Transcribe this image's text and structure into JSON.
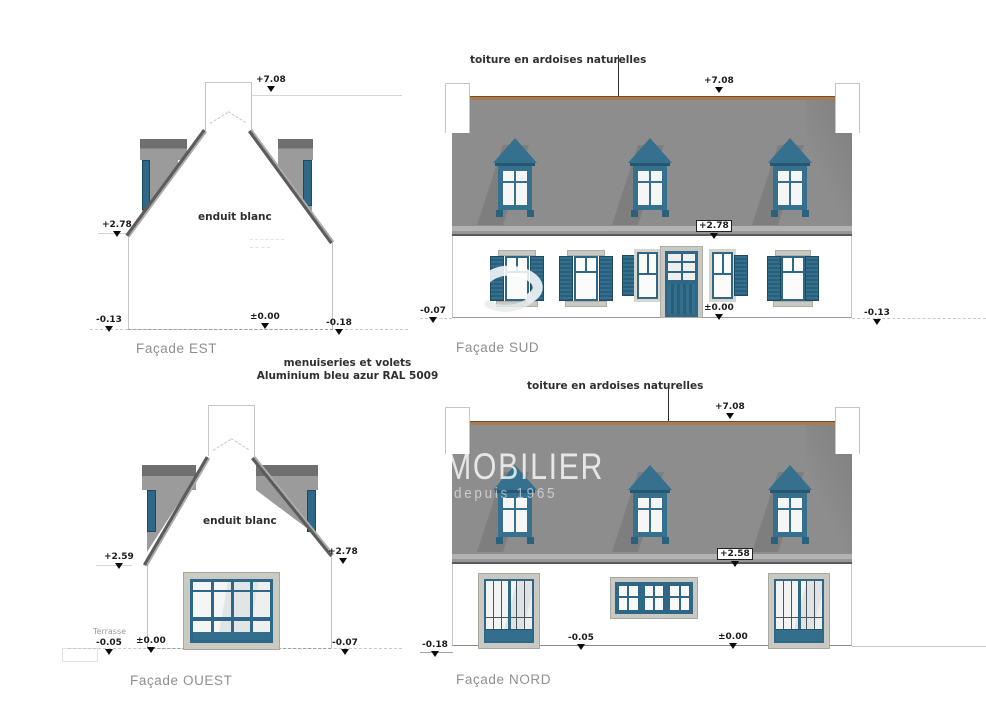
{
  "annotations": {
    "roof_note": "toiture en ardoises naturelles",
    "wall_note": "enduit blanc",
    "terrace_label": "Terrasse",
    "joinery_note_line1": "menuiseries et volets",
    "joinery_note_line2": "Aluminium bleu azur RAL 5009"
  },
  "watermark": {
    "line1": "MOBILIER",
    "line2": "depuis 1965"
  },
  "facades": {
    "est": {
      "title": "Façade EST",
      "levels": {
        "ridge": "+7.08",
        "eave_left": "+2.78",
        "ground_left": "-0.13",
        "ground_center": "±0.00",
        "ground_right": "-0.18"
      }
    },
    "sud": {
      "title": "Façade SUD",
      "levels": {
        "ridge": "+7.08",
        "eave": "+2.78",
        "ground_left": "-0.07",
        "ground_center": "±0.00",
        "ground_right": "-0.13"
      }
    },
    "ouest": {
      "title": "Façade OUEST",
      "levels": {
        "eave_left": "+2.59",
        "eave_right": "+2.78",
        "terrace": "-0.05",
        "ground_center": "±0.00",
        "ground_right": "-0.07"
      }
    },
    "nord": {
      "title": "Façade NORD",
      "levels": {
        "ridge": "+7.08",
        "eave": "+2.58",
        "ground_far_left": "-0.18",
        "terrace": "-0.05",
        "ground_center": "±0.00"
      }
    }
  },
  "colors": {
    "joinery_blue": "#2f6886",
    "roof_gray": "#8d8d8d",
    "ridge_brown": "#aa7b50",
    "stone": "#c9c8c2"
  }
}
